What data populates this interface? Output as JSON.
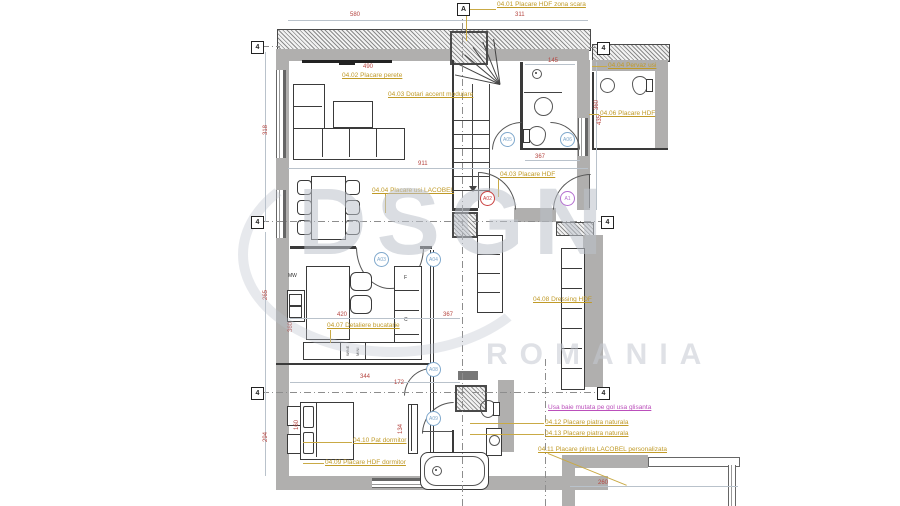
{
  "watermark": {
    "brand": "DSGN",
    "country": "ROMANIA"
  },
  "grid": {
    "a": "A",
    "four": "4"
  },
  "annotations": {
    "scara": "04.01 Placare HDF zona scara",
    "perete": "04.02 Placare perete",
    "accent": "04.03 Dotari accent modulare",
    "pervaz": "04.04 Pervaz usi",
    "hdf_dreapta": "04.06 Placare HDF",
    "usi_lacobel": "04.04 Placare usi LACOBEL",
    "hdf_intrare": "04.03 Placare HDF",
    "dressing": "04.08 Dressing HDF",
    "bucatarie": "04.07 Detaliere bucatarie",
    "pat": "04.10 Pat dormitor",
    "hdf_dormitor": "04.09 Placare HDF dormitor",
    "usa_baie": "Usa baie mutata pe gol usa glisanta",
    "piatra1": "04.12 Placare piatra naturala",
    "piatra2": "04.13 Placare piatra naturala",
    "plinta": "04.11 Placare plinta LACOBEL personalizata"
  },
  "dimensions": {
    "top_left": "580",
    "top_right": "311",
    "tv": "490",
    "living_w": "911",
    "living_h": "435",
    "left_top": "318",
    "left_mid": "265",
    "left_bottom": "294",
    "kitchen_w": "420",
    "hall_w": "367",
    "kitchen_h": "360",
    "bed_w": "344",
    "bed_d": "172",
    "bath_door": "134",
    "bed_h": "160",
    "bath_top_w": "145",
    "bath_top_h": "360",
    "bath_top_w2": "367",
    "detail": "260"
  },
  "door_tags": {
    "hall_red": "A02",
    "entry_purple": "A1",
    "stair": "A05",
    "bath_top": "A06",
    "kitchen_1": "A03",
    "kitchen_2": "A04",
    "bedroom": "A08",
    "bath_bottom": "A09"
  },
  "appliance_labels": {
    "mw": "MW",
    "fridge": "F",
    "oven": "C",
    "wine": "WINE",
    "mini": "MINI"
  }
}
